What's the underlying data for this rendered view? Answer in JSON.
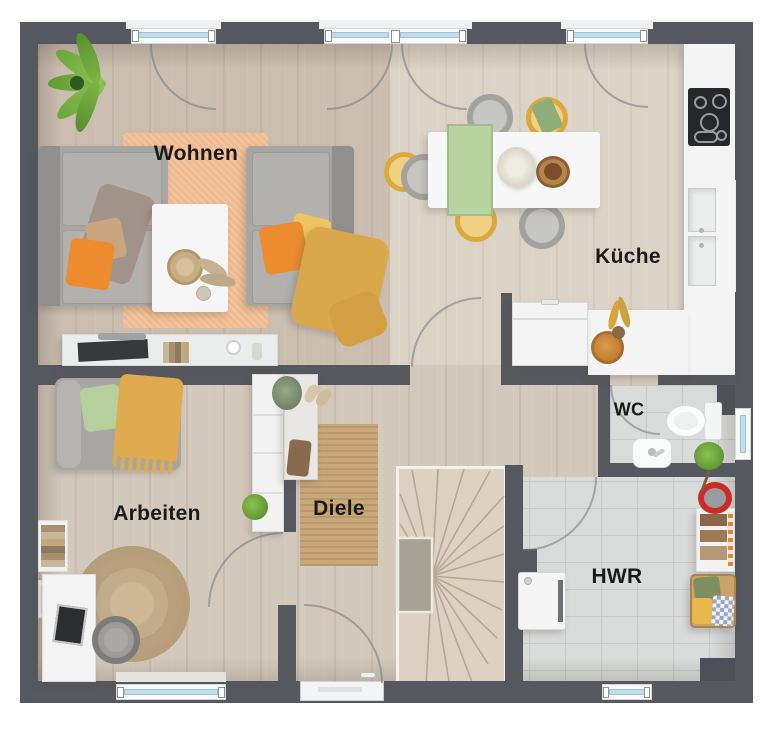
{
  "plan": {
    "type": "floor-plan",
    "floor": "Erdgeschoss",
    "rooms": {
      "wohnen": {
        "label": "Wohnen"
      },
      "kueche": {
        "label": "Küche"
      },
      "wc": {
        "label": "WC"
      },
      "arbeiten": {
        "label": "Arbeiten"
      },
      "diele": {
        "label": "Diele"
      },
      "hwr": {
        "label": "HWR"
      }
    },
    "furniture": {
      "wohnen": [
        "sofa",
        "armchair",
        "coffee-table",
        "rug",
        "tv-lowboard",
        "palm-plant",
        "pillows",
        "blanket"
      ],
      "kueche": [
        "dining-table",
        "dining-chairs",
        "kitchen-counter",
        "cooktop",
        "sink",
        "freezer-chest",
        "fruit-bowl",
        "flower-vase"
      ],
      "wc": [
        "toilet",
        "washbasin",
        "plant"
      ],
      "arbeiten": [
        "daybed",
        "desk",
        "office-chair",
        "round-rug",
        "shelf-cabinet",
        "wall-shelves"
      ],
      "diele": [
        "console-table",
        "runner-rug",
        "front-door"
      ],
      "hwr": [
        "washing-machine",
        "laundry-basket",
        "storage-shelf",
        "bucket"
      ],
      "treppe": [
        "winder-staircase"
      ]
    },
    "colors": {
      "wall": "#55585e",
      "wood_floor": "#d2c8bb",
      "tile_floor": "#d9dbda",
      "living_rug": "#f0ba90",
      "hall_rug": "#c8a878",
      "office_rug": "#cdb794",
      "accent_orange": "#ec8c2e",
      "accent_yellow": "#edc65f",
      "accent_green": "#b7cf9d",
      "window_glass": "#c3dcea",
      "counter_white": "#f3f4f3"
    },
    "window_count": 7,
    "door_count": 6
  }
}
